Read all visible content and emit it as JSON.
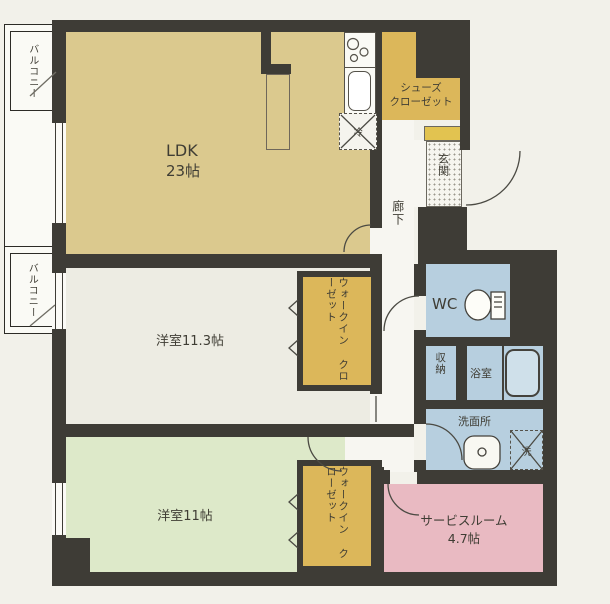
{
  "plan": {
    "balcony_top": "バルコニー",
    "balcony_left": "バルコニー",
    "ldk": {
      "label": "LDK",
      "area": "23帖"
    },
    "kitchen": {
      "fridge": "冷"
    },
    "shoe_closet": {
      "line1": "シューズ",
      "line2": "クローゼット"
    },
    "entrance": "玄関",
    "hallway": "廊下",
    "wc": "WC",
    "storage": "収納",
    "bathroom": "浴室",
    "washroom": {
      "label": "洗面所",
      "washer": "洗"
    },
    "bedroom1": "洋室11.3帖",
    "bedroom2": "洋室11帖",
    "service_room": {
      "label": "サービスルーム",
      "area": "4.7帖"
    },
    "wic1": {
      "line1": "ウォークイン",
      "line2": "クローゼット"
    },
    "wic2": {
      "line1": "ウォークイン",
      "line2": "クローゼット"
    }
  },
  "colors": {
    "wall": "#3e3c36",
    "ldk": "#dbc98e",
    "closet": "#dcb75a",
    "bedroom1": "#edece3",
    "bedroom2": "#dde9c9",
    "service_room": "#e9bac2",
    "wet_rooms": "#b7cfdf",
    "entrance_mat": "#e2c350"
  }
}
